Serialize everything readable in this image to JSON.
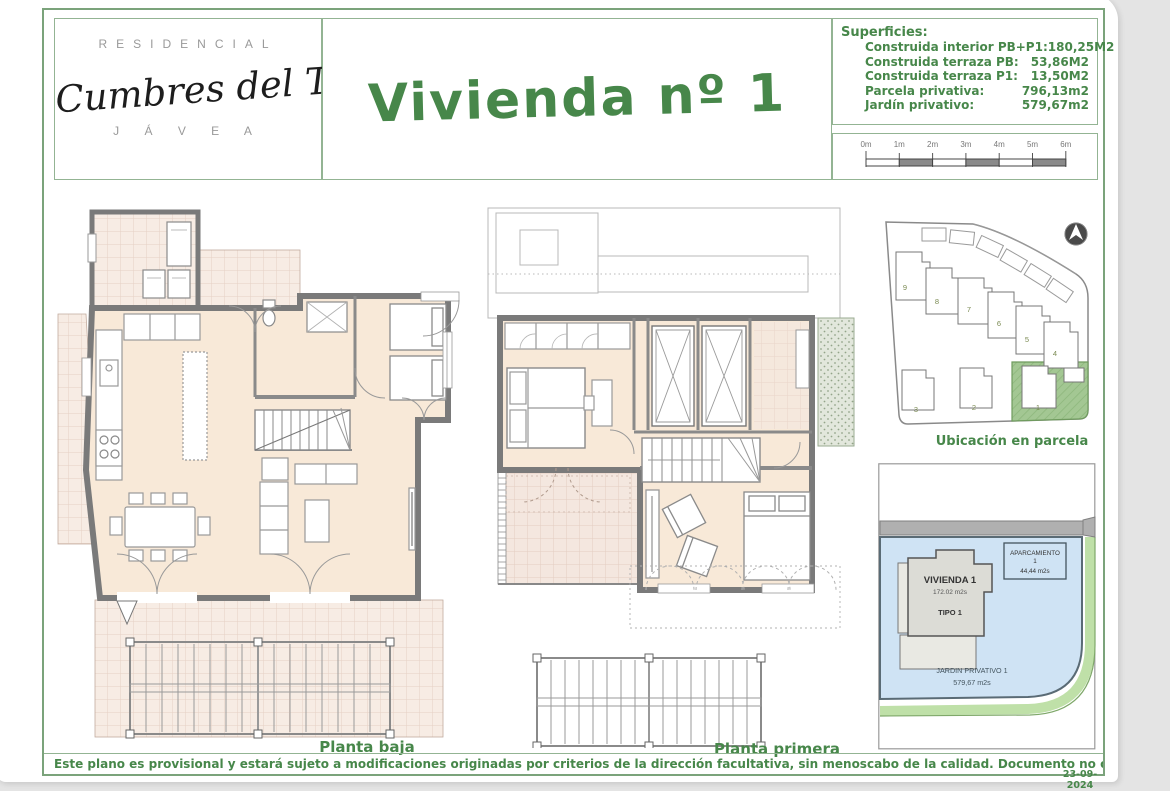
{
  "colors": {
    "accent_green": "#47874a",
    "frame_green": "#7ba37b",
    "wall_gray": "#7a7a7a",
    "floor_beige": "#f8e9d8",
    "terrace_tile": "#f7ece4",
    "garden_blue": "#cfe3f4",
    "parcel_green": "#a3c793",
    "road_gray": "#b0b0b0"
  },
  "header": {
    "residencial": "RESIDENCIAL",
    "brand": "Cumbres del Tosalet",
    "city": "J Á V E A",
    "title": "Vivienda nº 1"
  },
  "superficies": {
    "heading": "Superficies:",
    "rows": [
      {
        "label": "Construida interior PB+P1:",
        "value": "180,25M2"
      },
      {
        "label": "Construida terraza PB:",
        "value": "53,86M2"
      },
      {
        "label": "Construida terraza P1:",
        "value": "13,50M2"
      },
      {
        "label": "Parcela privativa:",
        "value": "796,13m2"
      },
      {
        "label": "Jardín privativo:",
        "value": "579,67m2"
      }
    ]
  },
  "scalebar": {
    "ticks": [
      "0m",
      "1m",
      "2m",
      "3m",
      "4m",
      "5m",
      "6m"
    ]
  },
  "plans": {
    "ground_label": "Planta baja",
    "first_label": "Planta primera"
  },
  "siteplan": {
    "label": "Ubicación en parcela",
    "numbers": [
      "1",
      "2",
      "3",
      "4",
      "5",
      "6",
      "7",
      "8",
      "9"
    ]
  },
  "parcel_detail": {
    "vivienda_name": "VIVIENDA 1",
    "vivienda_area": "172.02 m2s",
    "vivienda_type": "TIPO 1",
    "aparcamiento_name": "APARCAMIENTO",
    "aparcamiento_number": "1",
    "aparcamiento_area": "44,44 m2s",
    "jardin_name": "JARDIN PRIVATIVO 1",
    "jardin_area": "579,67 m2s"
  },
  "footer": {
    "disclaimer": "Este plano es provisional y estará sujeto a modificaciones originadas por criterios de la dirección facultativa, sin menoscabo de la calidad. Documento no contractual.",
    "date": "23-09-2024"
  }
}
